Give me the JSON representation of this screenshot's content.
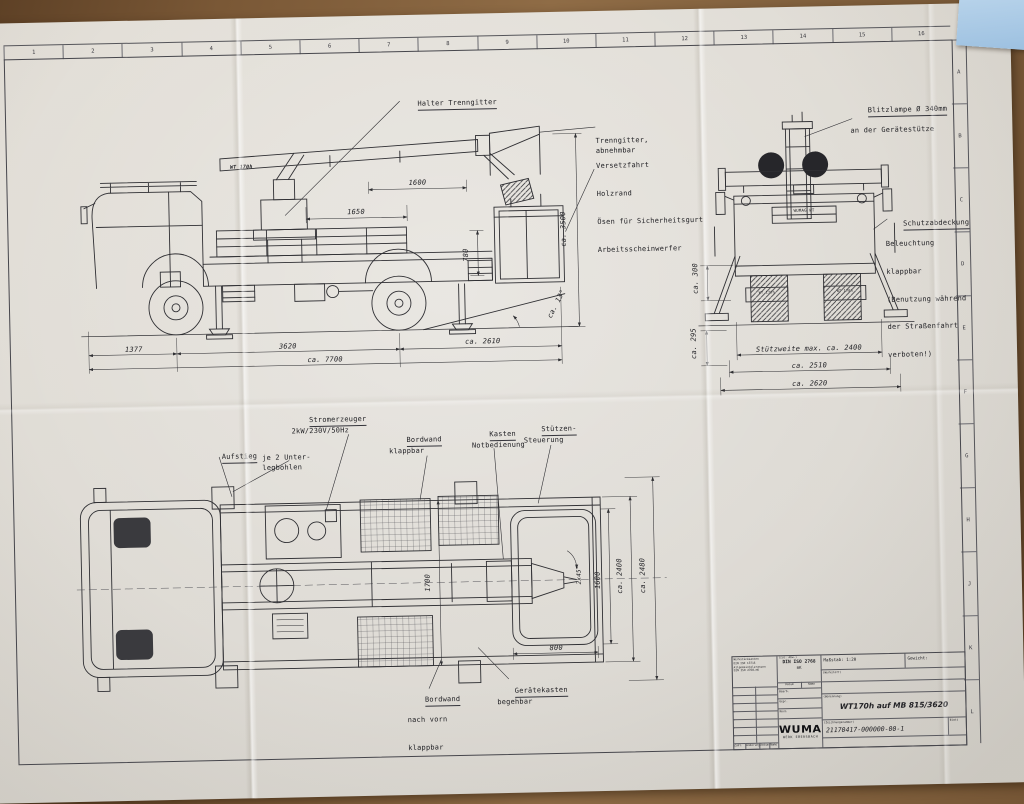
{
  "scene": {
    "desk_color": "#7a5836",
    "note_color": "#a9c7e3",
    "paper_color": "#e9e6e0",
    "line_color": "#2f2f33"
  },
  "frame": {
    "top_ticks": [
      "1",
      "2",
      "3",
      "4",
      "5",
      "6",
      "7",
      "8",
      "9",
      "10",
      "11",
      "12",
      "13",
      "14",
      "15",
      "16"
    ],
    "side_rows": [
      "A",
      "B",
      "C",
      "D",
      "E",
      "F",
      "G",
      "H",
      "J",
      "K",
      "L"
    ]
  },
  "side_view": {
    "halter_label": "Halter Trenngitter",
    "right_label_1a": "Trenngitter,",
    "right_label_1b": "abnehmbar",
    "right_label_2a": "Versetzfahrt",
    "right_label_2b": "Holzrand",
    "right_label_2c": "Ösen für Sicherheitsgurt",
    "right_label_2d": "Arbeitsscheinwerfer",
    "dim_1650": "1650",
    "dim_1600": "1600",
    "dim_780": "780",
    "dim_3500": "ca. 3500",
    "dim_13deg": "ca. 13°",
    "dim_1377": "1377",
    "dim_3620": "3620",
    "dim_2610": "ca. 2610",
    "dim_7700": "ca. 7700",
    "boom_logo": "WT 170h"
  },
  "front_view": {
    "blitzlampe_1": "Blitzlampe Ø 340mm",
    "blitzlampe_2": "an der Gerätestütze",
    "schutz_1": "Schutzabdeckung",
    "schutz_2": "Beleuchtung",
    "schutz_3": "klappbar",
    "schutz_4": "(Benutzung während",
    "schutz_5": "der Straßenfahrt",
    "schutz_6": "verboten!)",
    "dim_300": "ca. 300",
    "dim_295": "ca. 295",
    "dim_stuetzweite": "Stützweite max. ca. 2400",
    "dim_2510": "ca. 2510",
    "dim_2620": "ca. 2620",
    "badge": "WUMAG WT",
    "marking_left": "WT 170h",
    "marking_right": "WT 170h"
  },
  "plan_view": {
    "aufstieg": "Aufstieg",
    "unterleg_1": "je 2 Unter-",
    "unterleg_2": "legbohlen",
    "strom_1": "Stromerzeuger",
    "strom_2": "2kW/230V/50Hz",
    "bordwand_1": "Bordwand",
    "bordwand_2": "klappbar",
    "kasten_1": "Kasten",
    "kasten_2": "Notbedienung",
    "stuetzen_1": "Stützen-",
    "stuetzen_2": "Steuerung",
    "bordwand_vorn_1": "Bordwand",
    "bordwand_vorn_2": "nach vorn",
    "bordwand_vorn_3": "klappbar",
    "geraete_1": "Gerätekasten",
    "geraete_2": "begehbar",
    "dim_1700": "1700",
    "dim_800": "800",
    "dim_1600": "1600",
    "dim_2x45": "2x45°",
    "dim_2400": "ca. 2400",
    "dim_2480": "ca. 2480"
  },
  "title_block": {
    "smallprint": [
      "Werkstückkanten",
      "DIN ISO 13715",
      "Allgemeintoleranzen",
      "DIN ISO 2768-mK"
    ],
    "zul_abw": "(zul. Abw.)",
    "din": "DIN ISO 2768",
    "din_class": "mK",
    "datum": "Datum",
    "name": "Name",
    "bearb": "Bearb.",
    "gepr": "Gepr.",
    "norm": "Norm",
    "massstab": "Maßstab: 1:20",
    "gewicht": "Gewicht:",
    "werkstoff": "(Werkstoff)",
    "ident_label": "(Identnummer)",
    "ident_value": "21170417",
    "benennung_label": "(Benennung)",
    "benennung_value": "WT170h auf MB 815/3620",
    "zeichnung_label": "(Zeichnungsnummer)",
    "zeichnung_value": "21170417-000000-00-1",
    "blatt": "Blatt",
    "ersatz_label": "(Ersatz für)",
    "ersatz_value": "21170417-000000-00-1",
    "company": "WUMAG",
    "plant": "WERK EBERSBACH",
    "zust": "Zust.",
    "aenderung": "Änderung",
    "datum2": "Datum",
    "name2": "Name"
  }
}
